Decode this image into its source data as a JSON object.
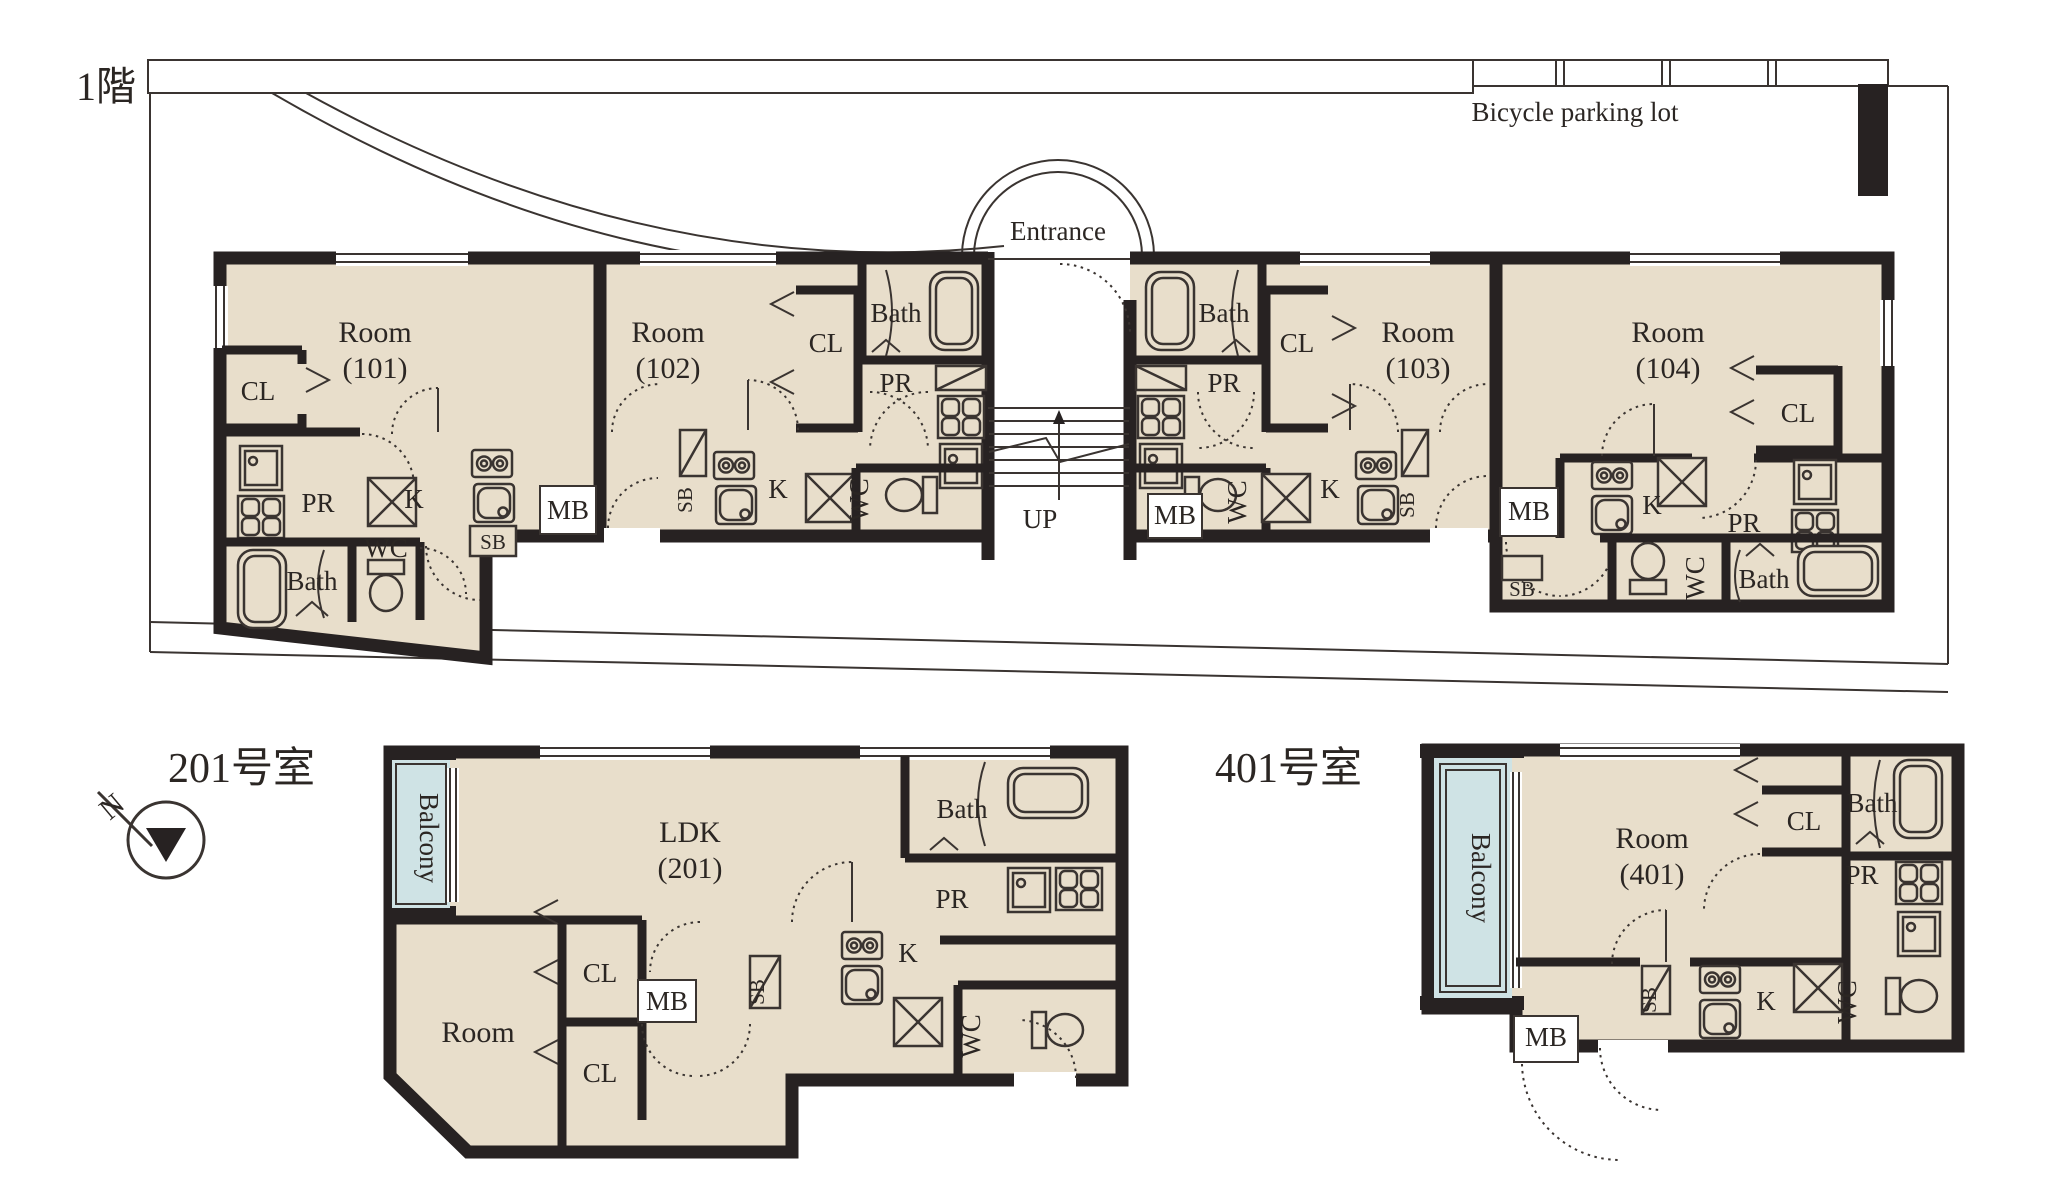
{
  "colors": {
    "room_fill": "#e8decb",
    "wall": "#272222",
    "balcony_fill": "#cfe3e5",
    "line": "#3a3431",
    "text": "#2b2623",
    "bg": "#ffffff"
  },
  "f1": {
    "title": "1階",
    "bicycle": "Bicycle parking lot",
    "entrance": "Entrance",
    "up": "UP",
    "u101": {
      "room": "Room",
      "num": "(101)",
      "cl": "CL",
      "pr": "PR",
      "k": "K",
      "sb": "SB",
      "mb": "MB",
      "wc": "WC",
      "bath": "Bath"
    },
    "u102": {
      "room": "Room",
      "num": "(102)",
      "cl": "CL",
      "bath": "Bath",
      "pr": "PR",
      "sb": "SB",
      "k": "K",
      "wc": "WC"
    },
    "u103": {
      "room": "Room",
      "num": "(103)",
      "cl": "CL",
      "bath": "Bath",
      "pr": "PR",
      "sb": "SB",
      "k": "K",
      "wc": "WC",
      "mb": "MB"
    },
    "u104": {
      "room": "Room",
      "num": "(104)",
      "cl": "CL",
      "bath": "Bath",
      "pr": "PR",
      "sb": "SB",
      "k": "K",
      "wc": "WC",
      "mb": "MB"
    }
  },
  "p201": {
    "title": "201号室",
    "balcony": "Balcony",
    "ldk": "LDK",
    "num": "(201)",
    "room": "Room",
    "cl1": "CL",
    "cl2": "CL",
    "mb": "MB",
    "sb": "SB",
    "k": "K",
    "bath": "Bath",
    "pr": "PR",
    "wc": "WC"
  },
  "p401": {
    "title": "401号室",
    "balcony": "Balcony",
    "room": "Room",
    "num": "(401)",
    "cl": "CL",
    "bath": "Bath",
    "pr": "PR",
    "mb": "MB",
    "sb": "SB",
    "k": "K",
    "wc": "WC"
  },
  "north": {
    "n": "N"
  }
}
